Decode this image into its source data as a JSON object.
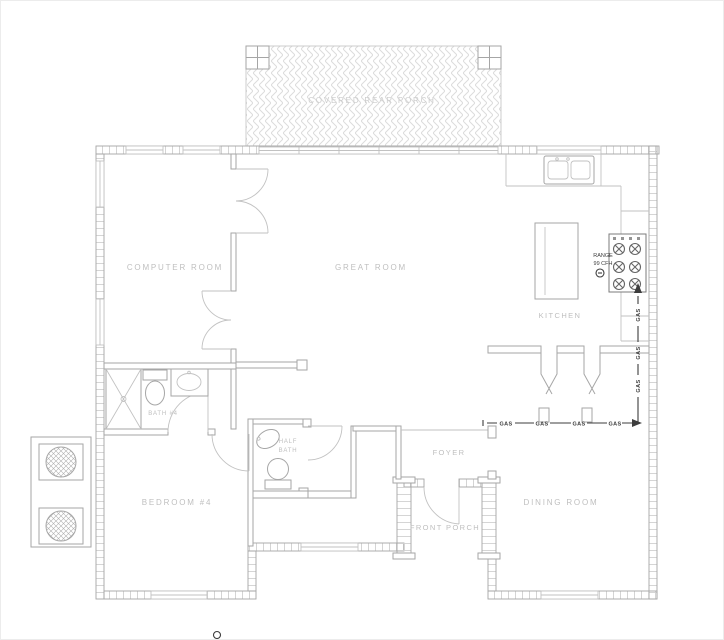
{
  "plan": {
    "rooms": {
      "rear_porch": "COVERED REAR PORCH",
      "computer_room": "COMPUTER ROOM",
      "great_room": "GREAT ROOM",
      "kitchen": "KITCHEN",
      "bath_4": "BATH #4",
      "half_bath_l1": "HALF",
      "half_bath_l2": "BATH",
      "bedroom_4": "BEDROOM #4",
      "foyer": "FOYER",
      "front_porch": "FRONT PORCH",
      "dining_room": "DINING ROOM"
    },
    "annotations": {
      "range_l1": "RANGE",
      "range_l2": "99 CFH",
      "gas": "GAS"
    },
    "colors": {
      "line": "#a6a6a6",
      "light": "#c2c2c2",
      "label": "#bfbfbf",
      "faint": "#cccccc",
      "dark": "#3d3d3d",
      "tick": "#d0d0d0",
      "hatch": "#dcdcdc",
      "bg": "#ffffff"
    }
  }
}
